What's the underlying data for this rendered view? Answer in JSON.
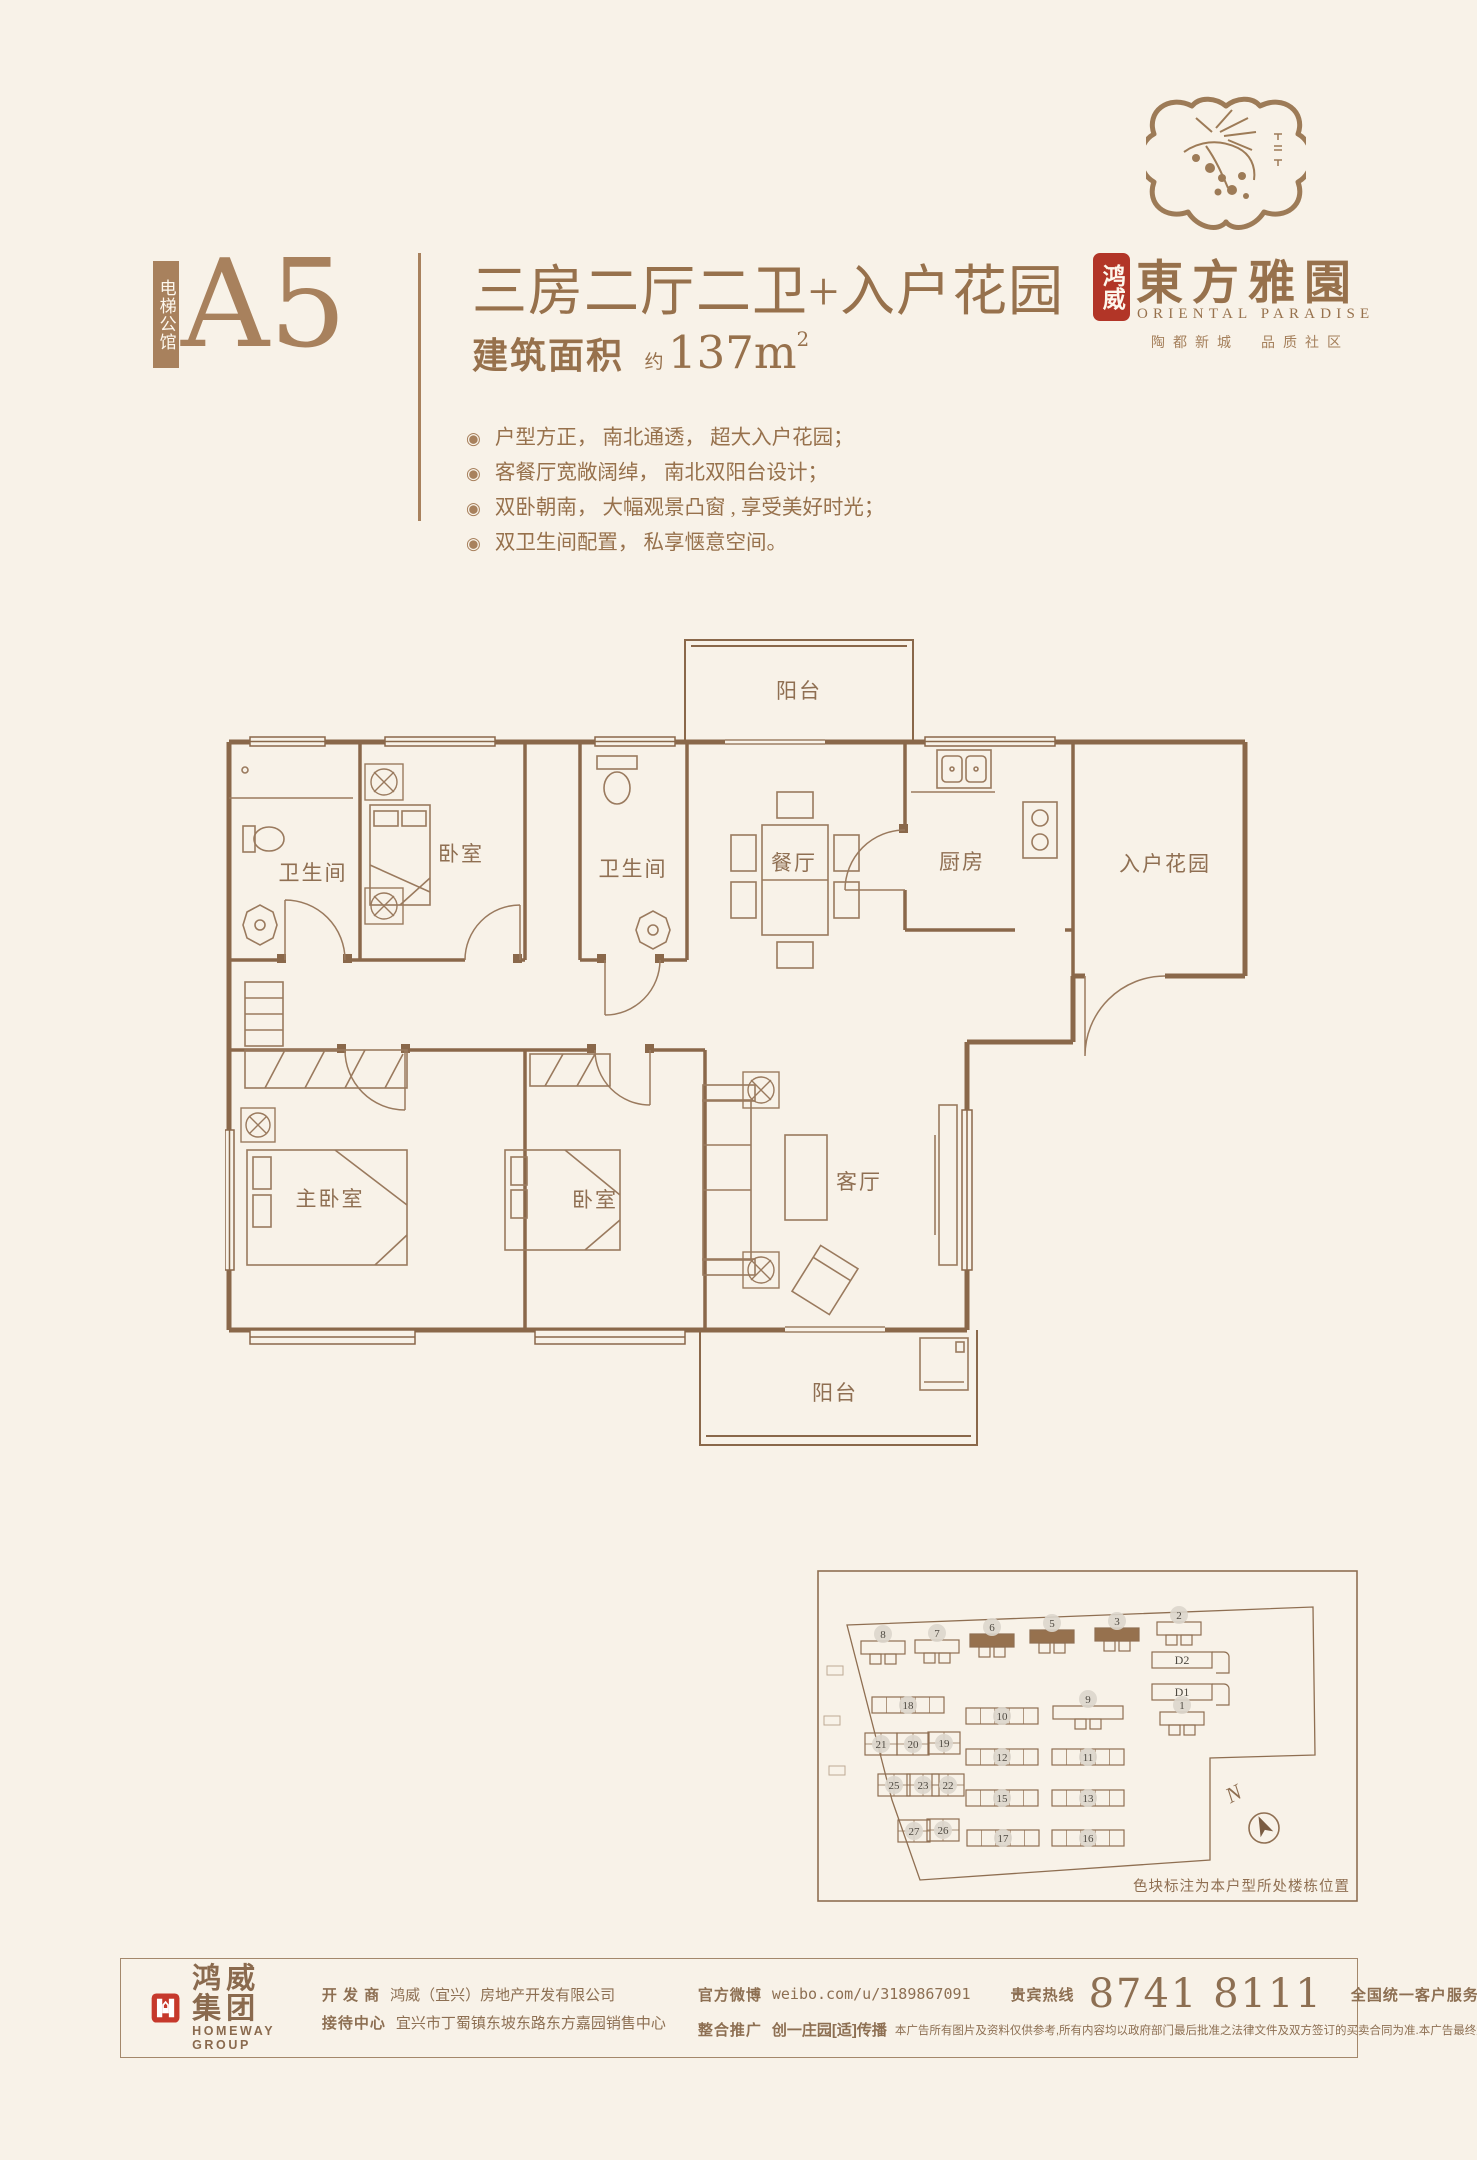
{
  "header": {
    "strip_label": "电梯公馆",
    "unit_code": "A5",
    "title": "三房二厅二卫+入户花园",
    "area_label": "建筑面积",
    "area_approx": "约",
    "area_value": "137m",
    "area_sup": "2",
    "bullet_glyph": "◉",
    "features": [
      "户型方正， 南北通透， 超大入户花园；",
      "客餐厅宽敞阔绰， 南北双阳台设计；",
      "双卧朝南， 大幅观景凸窗 , 享受美好时光；",
      "双卫生间配置， 私享惬意空间。"
    ]
  },
  "brand": {
    "seal_text": "鸿威",
    "name_cn": "東方雅園",
    "name_en": "ORIENTAL PARADISE",
    "slogan": "陶都新城　品质社区"
  },
  "floorplan": {
    "rooms": [
      {
        "label": "阳台"
      },
      {
        "label": "卫生间"
      },
      {
        "label": "卧室"
      },
      {
        "label": "卫生间"
      },
      {
        "label": "餐厅"
      },
      {
        "label": "厨房"
      },
      {
        "label": "入户花园"
      },
      {
        "label": "主卧室"
      },
      {
        "label": "卧室"
      },
      {
        "label": "客厅"
      },
      {
        "label": "阳台"
      }
    ]
  },
  "siteplan": {
    "caption": "色块标注为本户型所处楼栋位置",
    "north_label": "N",
    "highlight_color": "#96714e",
    "buildings": [
      {
        "label": "8",
        "x": 66,
        "y": 77,
        "type": "tower",
        "hl": false
      },
      {
        "label": "7",
        "x": 120,
        "y": 76,
        "type": "tower",
        "hl": false
      },
      {
        "label": "6",
        "x": 175,
        "y": 70,
        "type": "tower",
        "hl": true
      },
      {
        "label": "5",
        "x": 235,
        "y": 66,
        "type": "tower",
        "hl": true
      },
      {
        "label": "3",
        "x": 300,
        "y": 64,
        "type": "tower",
        "hl": true
      },
      {
        "label": "2",
        "x": 362,
        "y": 58,
        "type": "tower",
        "hl": false
      },
      {
        "label": "D2",
        "x": 365,
        "y": 90,
        "type": "d",
        "hl": false
      },
      {
        "label": "D1",
        "x": 365,
        "y": 122,
        "type": "d",
        "hl": false
      },
      {
        "label": "1",
        "x": 365,
        "y": 148,
        "type": "tower",
        "hl": false
      },
      {
        "label": "18",
        "x": 91,
        "y": 135,
        "type": "slab",
        "hl": false
      },
      {
        "label": "10",
        "x": 185,
        "y": 146,
        "type": "slab",
        "hl": false
      },
      {
        "label": "9",
        "x": 271,
        "y": 142,
        "type": "tower-wide",
        "hl": false
      },
      {
        "label": "21",
        "x": 64,
        "y": 174,
        "type": "cluster",
        "hl": false
      },
      {
        "label": "20",
        "x": 96,
        "y": 174,
        "type": "cluster",
        "hl": false
      },
      {
        "label": "19",
        "x": 127,
        "y": 173,
        "type": "cluster",
        "hl": false
      },
      {
        "label": "12",
        "x": 185,
        "y": 187,
        "type": "slab",
        "hl": false
      },
      {
        "label": "11",
        "x": 271,
        "y": 187,
        "type": "slab",
        "hl": false
      },
      {
        "label": "25",
        "x": 77,
        "y": 215,
        "type": "cluster",
        "hl": false
      },
      {
        "label": "23",
        "x": 106,
        "y": 215,
        "type": "cluster",
        "hl": false
      },
      {
        "label": "22",
        "x": 131,
        "y": 215,
        "type": "cluster",
        "hl": false
      },
      {
        "label": "15",
        "x": 185,
        "y": 228,
        "type": "slab",
        "hl": false
      },
      {
        "label": "13",
        "x": 271,
        "y": 228,
        "type": "slab",
        "hl": false
      },
      {
        "label": "27",
        "x": 97,
        "y": 261,
        "type": "cluster",
        "hl": false
      },
      {
        "label": "26",
        "x": 126,
        "y": 260,
        "type": "cluster",
        "hl": false
      },
      {
        "label": "17",
        "x": 186,
        "y": 268,
        "type": "slab",
        "hl": false
      },
      {
        "label": "16",
        "x": 271,
        "y": 268,
        "type": "slab",
        "hl": false
      }
    ]
  },
  "footer": {
    "logo_cn": "鸿威集团",
    "logo_en": "HOMEWAY GROUP",
    "developer_label": "开 发 商",
    "developer_value": "鸿威（宜兴）房地产开发有限公司",
    "reception_label": "接待中心",
    "reception_value": "宜兴市丁蜀镇东坡东路东方嘉园销售中心",
    "weibo_label": "官方微博",
    "weibo_value": "weibo.com/u/3189867091",
    "vip_label": "贵宾热线",
    "vip_number": "8741 8111",
    "service_label": "全国统一客户服务热线:",
    "service_number": "40061 80061",
    "promo_label": "整合推广",
    "promo_value": "创一庄园[适]传播",
    "disclaimer": "本广告所有图片及资料仅供参考,所有内容均以政府部门最后批准之法律文件及双方签订的买卖合同为准.本广告最终解释权归开发商所有."
  }
}
